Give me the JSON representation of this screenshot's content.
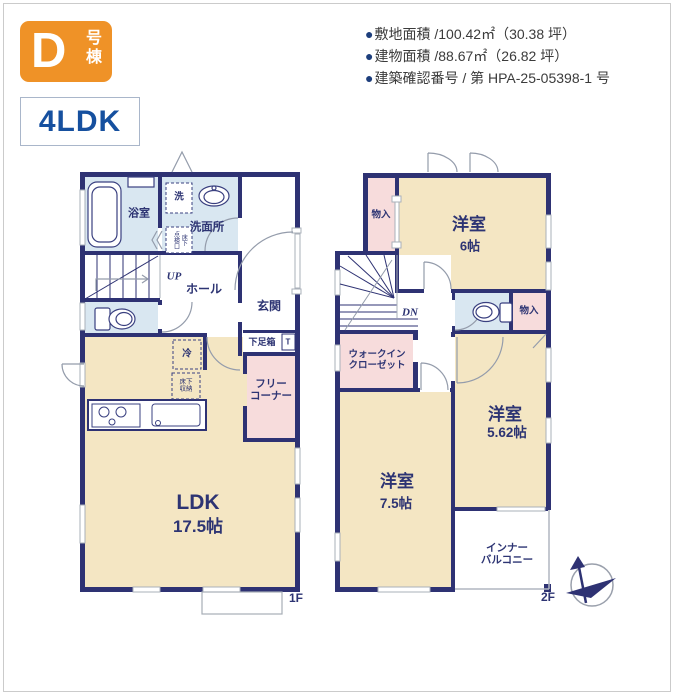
{
  "header": {
    "badge": {
      "letter": "D",
      "word_vertical": "号棟"
    },
    "plan_type": "4LDK",
    "info": [
      {
        "bullet": "●",
        "text": "敷地面積 /100.42㎡（30.38 坪）"
      },
      {
        "bullet": "●",
        "text": "建物面積 /88.67㎡（26.82 坪）"
      },
      {
        "bullet": "●",
        "text": "建築確認番号 / 第 HPA-25-05398-1 号"
      }
    ]
  },
  "floor1": {
    "label": "1F",
    "bath": "浴室",
    "washroom": "洗面所",
    "laundry": "洗",
    "hatch_left": "点検口",
    "hatch_right": "床下",
    "up": "UP",
    "hall": "ホール",
    "entrance": "玄関",
    "shoebox": "下足箱",
    "toilet_mark": "T",
    "fridge": "冷",
    "underfloor1": "床下",
    "underfloor2": "収納",
    "free1": "フリー",
    "free2": "コーナー",
    "ldk": "LDK",
    "ldk_size": "17.5帖"
  },
  "floor2": {
    "label": "2F",
    "closet_a": "物入",
    "closet_b": "物入",
    "room6": "洋室",
    "room6_size": "6帖",
    "dn": "DN",
    "wic1": "ウォークイン",
    "wic2": "クローゼット",
    "room562": "洋室",
    "room562_size": "5.62帖",
    "room75": "洋室",
    "room75_size": "7.5帖",
    "balcony1": "インナー",
    "balcony2": "バルコニー"
  },
  "colors": {
    "wall_navy": "#2e3273",
    "floor_cream": "#f4e6c3",
    "floor_pink": "#f7dcdc",
    "floor_blue": "#d9e7f1",
    "badge_orange": "#ef9227",
    "plan_type_blue": "#16509f",
    "label_navy": "#2d3473",
    "info_text": "#3b3b3b",
    "bullet_blue": "#1d3e7c"
  }
}
